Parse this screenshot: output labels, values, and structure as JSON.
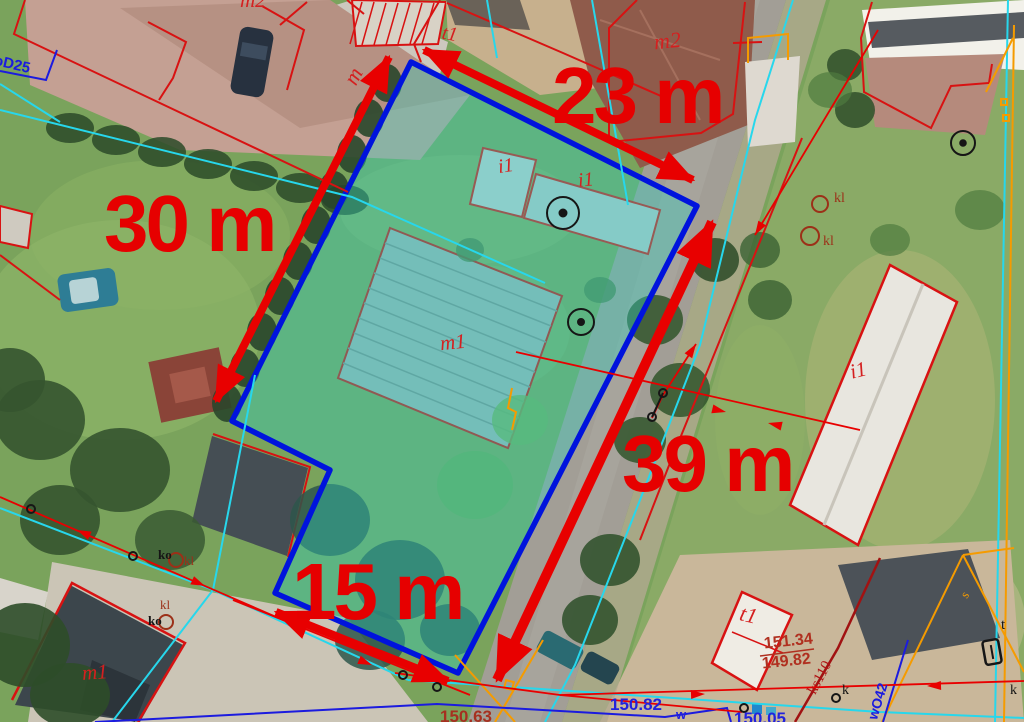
{
  "annotations": {
    "dimensions": {
      "top": "23 m",
      "left": "30 m",
      "right": "39 m",
      "bottom": "15 m"
    },
    "codes": {
      "m1": "m1",
      "m2": "m2",
      "i1": "i1",
      "t1": "t1",
      "m": "m",
      "kl": "kl",
      "ko": "ko",
      "k": "k",
      "t": "t",
      "s": "s"
    },
    "utility_labels": {
      "pipe_top_left": "oD25",
      "sewer_line": "ks110",
      "water_line": "wO42"
    },
    "elevations": {
      "ratio_upper": "151.34",
      "ratio_lower": "149.82",
      "level_center": "150.82",
      "level_left": "150.63",
      "level_right": "150.05",
      "w_mark": "w"
    },
    "colors": {
      "dimension_red": "#e60000",
      "parcel_blue": "#0013dd",
      "parcel_fill_teal": "#2fd0c0",
      "utility_cyan": "#27d7ec",
      "utility_orange": "#f59b00",
      "survey_blue": "#1b1bdf",
      "label_brown": "#9c3018",
      "boundary_red": "#d81212"
    }
  }
}
